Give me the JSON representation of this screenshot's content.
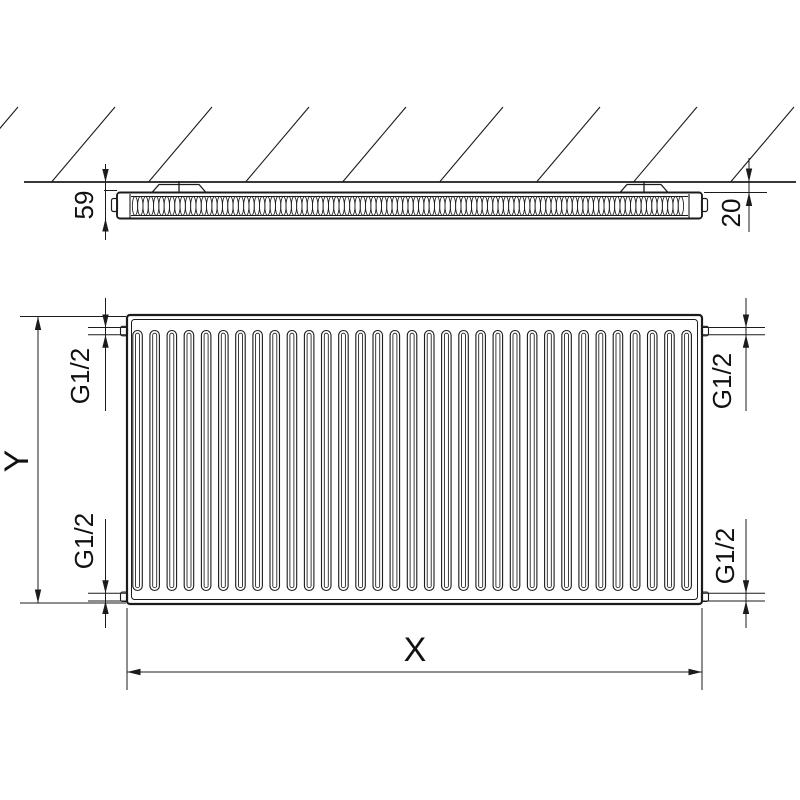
{
  "labels": {
    "depth_total": "59",
    "wall_distance": "20",
    "height_axis": "Y",
    "width_axis": "X",
    "conn_top_left": "G1/2",
    "conn_bottom_left": "G1/2",
    "conn_top_right": "G1/2",
    "conn_bottom_right": "G1/2"
  },
  "colors": {
    "line": "#1b1b1b",
    "background": "#ffffff"
  },
  "geometry": {
    "front_slot_count": 33,
    "hatch_line_count": 9
  }
}
